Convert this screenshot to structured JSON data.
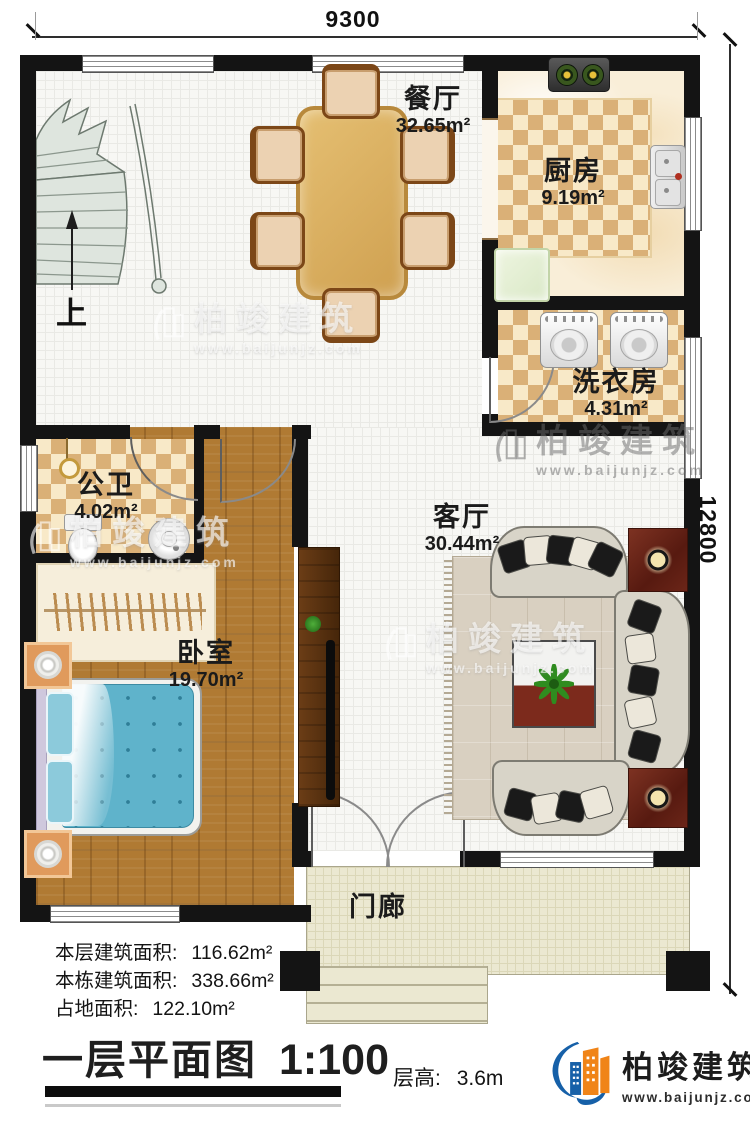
{
  "dimensions": {
    "width_label": "9300",
    "height_label": "12800"
  },
  "stairs": {
    "up_label": "上"
  },
  "rooms": {
    "dining": {
      "name": "餐厅",
      "area": "32.65m²"
    },
    "kitchen": {
      "name": "厨房",
      "area": "9.19m²"
    },
    "laundry": {
      "name": "洗衣房",
      "area": "4.31m²"
    },
    "bathroom": {
      "name": "公卫",
      "area": "4.02m²"
    },
    "bedroom": {
      "name": "卧室",
      "area": "19.70m²"
    },
    "living": {
      "name": "客厅",
      "area": "30.44m²"
    },
    "porch": {
      "name": "门廊"
    }
  },
  "stats": {
    "line1": {
      "label": "本层建筑面积:",
      "value": "116.62m²"
    },
    "line2": {
      "label": "本栋建筑面积:",
      "value": "338.66m²"
    },
    "line3": {
      "label": "占地面积:",
      "value": "122.10m²"
    }
  },
  "title": {
    "name": "一层平面图",
    "scale": "1:100"
  },
  "floor_height": {
    "label": "层高:",
    "value": "3.6m"
  },
  "brand": {
    "name": "柏竣建筑",
    "url": "www.baijunjz.com"
  },
  "watermark": {
    "name": "柏竣建筑",
    "url": "www.baijunjz.com"
  },
  "colors": {
    "wall": "#141414",
    "checker": "#dab077",
    "wood": "#b07a33",
    "bed_blue": "#5fb3cb",
    "brand_blue": "#1660a8",
    "brand_orange": "#f08418"
  }
}
